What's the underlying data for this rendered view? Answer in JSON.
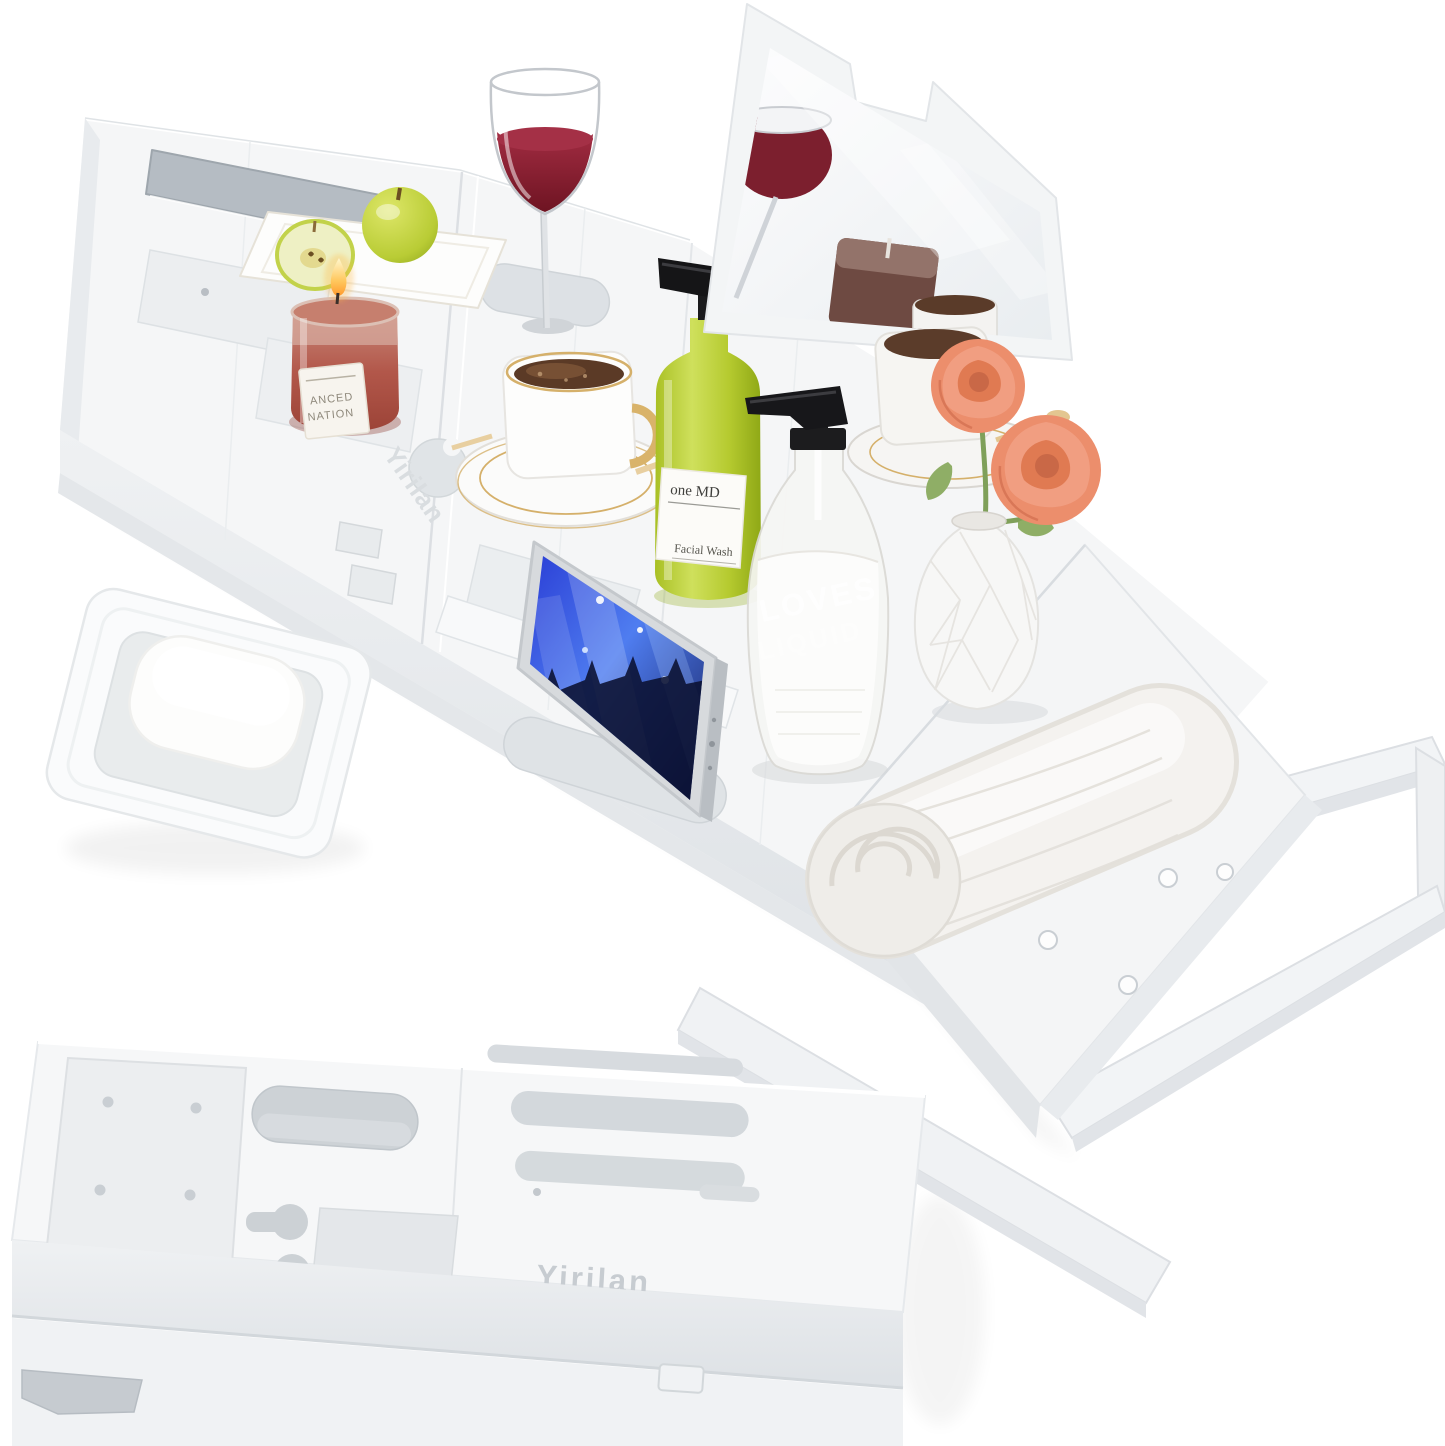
{
  "image": {
    "type": "product-photo",
    "background": "#ffffff",
    "brand": "Yirilan"
  },
  "main_tray": {
    "watermark": "Yirilan",
    "state": "extended with side arms out",
    "items": [
      "wine glass",
      "fruit plate",
      "green apples",
      "scented candle",
      "coffee cup with saucer",
      "facial wash bottle",
      "soap dispenser",
      "smartphone in slot",
      "mirror book stand",
      "vase with roses",
      "rolled towel",
      "soap dish with soap bar"
    ]
  },
  "candle": {
    "label_line1": "ANCED",
    "label_line2": "NATION",
    "wax_color": "#b2574a"
  },
  "green_bottle": {
    "label_line1": "one MD",
    "label_line2": "Facial Wash",
    "liquid_color": "#b5ca2f"
  },
  "pump_bottle": {
    "text_line1": "LOVES",
    "text_line2": "LIQUID"
  },
  "phone": {
    "screen_content": "concert crowd scene",
    "screen_color": "#3a5de0"
  },
  "wine": {
    "color": "#8e2135"
  },
  "roses": {
    "count": 2,
    "color": "#ec8e6c"
  },
  "soap_dish": {
    "contents": "white soap bar"
  },
  "folded_tray": {
    "engraving": "Yirilan",
    "state": "folded flat"
  },
  "colors": {
    "tray_white": "#f5f6f7",
    "recess": "#e3e6e9",
    "gold": "#d5b06a",
    "black_pump": "#1b1b1d"
  }
}
